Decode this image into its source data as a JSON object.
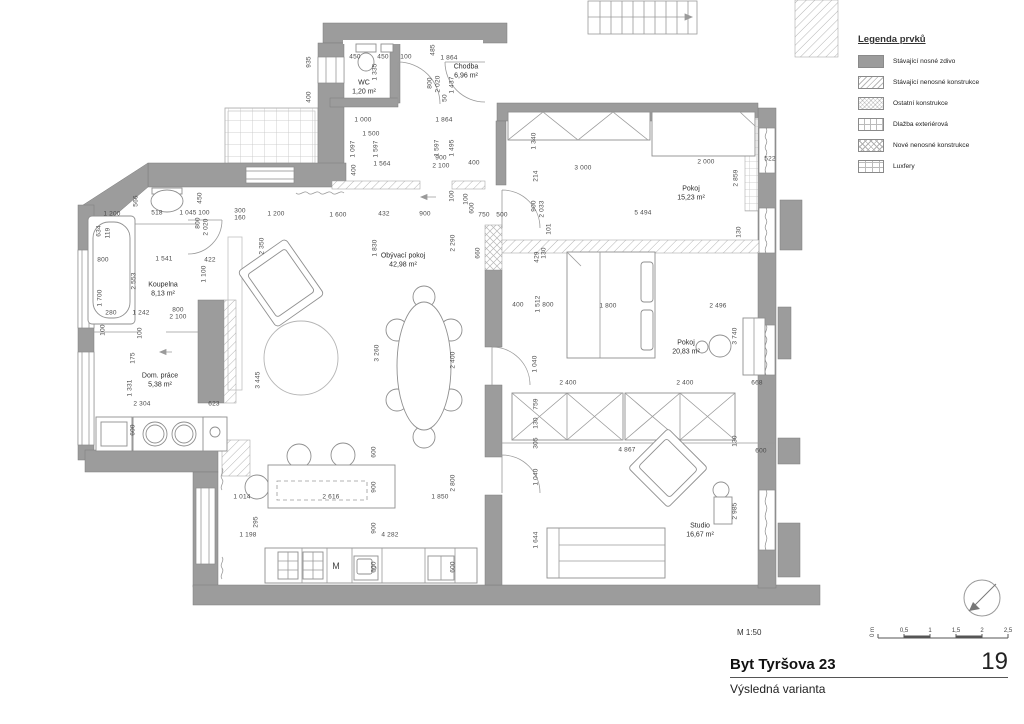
{
  "legend": {
    "title": "Legenda prvků",
    "items": [
      {
        "label": "Stávající nosné zdivo",
        "swatch": "solid"
      },
      {
        "label": "Stávající nenosné konstrukce",
        "swatch": "diag"
      },
      {
        "label": "Ostatní konstrukce",
        "swatch": "diag2"
      },
      {
        "label": "Dlažba exteriérová",
        "swatch": "grid"
      },
      {
        "label": "Nové nenosné konstrukce",
        "swatch": "cross"
      },
      {
        "label": "Luxfery",
        "swatch": "lux"
      }
    ]
  },
  "titleblock": {
    "scale_note": "M 1:50",
    "title": "Byt Tyršova 23",
    "sheet_number": "19",
    "subtitle": "Výsledná varianta",
    "scalebar_zero": "0 m",
    "scalebar_labels": [
      "0,5",
      "1",
      "1,5",
      "2",
      "2,5"
    ]
  },
  "rooms": [
    {
      "name": "WC",
      "area": "1,20 m²",
      "x": 364,
      "y": 88
    },
    {
      "name": "Chodba",
      "area": "6,96 m²",
      "x": 466,
      "y": 72
    },
    {
      "name": "Koupelna",
      "area": "8,13 m²",
      "x": 163,
      "y": 290
    },
    {
      "name": "Dom. práce",
      "area": "5,38 m²",
      "x": 160,
      "y": 381
    },
    {
      "name": "Obývací pokoj",
      "area": "42,98 m²",
      "x": 403,
      "y": 261
    },
    {
      "name": "Pokoj",
      "area": "15,23 m²",
      "x": 691,
      "y": 194
    },
    {
      "name": "Pokoj",
      "area": "20,83 m²",
      "x": 686,
      "y": 348
    },
    {
      "name": "Studio",
      "area": "16,67 m²",
      "x": 700,
      "y": 531
    }
  ],
  "appliance_label": {
    "text": "M",
    "x": 336,
    "y": 566
  },
  "dims": [
    [
      "450",
      355,
      57,
      0
    ],
    [
      "450",
      383,
      57,
      0
    ],
    [
      "100",
      406,
      57,
      0
    ],
    [
      "485",
      433,
      50,
      1
    ],
    [
      "1 864",
      449,
      58,
      0
    ],
    [
      "935",
      309,
      62,
      1
    ],
    [
      "400",
      309,
      97,
      1
    ],
    [
      "1 335",
      375,
      72,
      1
    ],
    [
      "800",
      430,
      83,
      1
    ],
    [
      "2 020",
      438,
      84,
      1
    ],
    [
      "1 437",
      452,
      85,
      1
    ],
    [
      "50",
      445,
      98,
      1
    ],
    [
      "1 000",
      363,
      120,
      0
    ],
    [
      "1 864",
      444,
      120,
      0
    ],
    [
      "1 500",
      371,
      134,
      0
    ],
    [
      "1 097",
      353,
      149,
      1
    ],
    [
      "1 597",
      376,
      149,
      1
    ],
    [
      "1 597",
      437,
      148,
      1
    ],
    [
      "1 495",
      452,
      148,
      1
    ],
    [
      "1 564",
      382,
      164,
      0
    ],
    [
      "900",
      441,
      158,
      0
    ],
    [
      "2 100",
      441,
      166,
      0
    ],
    [
      "400",
      474,
      163,
      0
    ],
    [
      "400",
      354,
      170,
      1
    ],
    [
      "100",
      452,
      196,
      1
    ],
    [
      "100",
      466,
      199,
      1
    ],
    [
      "600",
      472,
      208,
      1
    ],
    [
      "1 200",
      112,
      214,
      0
    ],
    [
      "566",
      136,
      201,
      1
    ],
    [
      "518",
      157,
      213,
      0
    ],
    [
      "450",
      200,
      198,
      1
    ],
    [
      "1 045",
      188,
      213,
      0
    ],
    [
      "100",
      204,
      213,
      0
    ],
    [
      "300",
      240,
      211,
      0
    ],
    [
      "160",
      240,
      218,
      0
    ],
    [
      "1 200",
      276,
      214,
      0
    ],
    [
      "1 600",
      338,
      215,
      0
    ],
    [
      "432",
      384,
      214,
      0
    ],
    [
      "900",
      425,
      214,
      0
    ],
    [
      "750",
      484,
      215,
      0
    ],
    [
      "500",
      502,
      215,
      0
    ],
    [
      "634",
      99,
      231,
      1
    ],
    [
      "119",
      108,
      233,
      1
    ],
    [
      "800",
      198,
      223,
      1
    ],
    [
      "2 020",
      206,
      227,
      1
    ],
    [
      "2 350",
      262,
      246,
      1
    ],
    [
      "800",
      103,
      260,
      0
    ],
    [
      "1 541",
      164,
      259,
      0
    ],
    [
      "422",
      210,
      260,
      0
    ],
    [
      "2 553",
      134,
      281,
      1
    ],
    [
      "1 100",
      204,
      274,
      1
    ],
    [
      "1 700",
      100,
      298,
      1
    ],
    [
      "280",
      111,
      313,
      0
    ],
    [
      "1 242",
      141,
      313,
      0
    ],
    [
      "800",
      178,
      310,
      0
    ],
    [
      "2 100",
      178,
      317,
      0
    ],
    [
      "100",
      103,
      330,
      1
    ],
    [
      "100",
      140,
      333,
      1
    ],
    [
      "175",
      133,
      358,
      1
    ],
    [
      "1 331",
      130,
      388,
      1
    ],
    [
      "2 304",
      142,
      404,
      0
    ],
    [
      "623",
      214,
      404,
      0
    ],
    [
      "600",
      133,
      430,
      1
    ],
    [
      "3 445",
      258,
      380,
      1
    ],
    [
      "1 830",
      375,
      248,
      1
    ],
    [
      "2 290",
      453,
      243,
      1
    ],
    [
      "660",
      478,
      253,
      1
    ],
    [
      "3 260",
      377,
      353,
      1
    ],
    [
      "2 400",
      453,
      360,
      1
    ],
    [
      "400",
      518,
      305,
      0
    ],
    [
      "800",
      548,
      305,
      0
    ],
    [
      "1 340",
      534,
      141,
      1
    ],
    [
      "3 000",
      583,
      168,
      0
    ],
    [
      "2 000",
      706,
      162,
      0
    ],
    [
      "522",
      770,
      159,
      0
    ],
    [
      "2 859",
      736,
      178,
      1
    ],
    [
      "214",
      536,
      176,
      1
    ],
    [
      "900",
      534,
      206,
      1
    ],
    [
      "2 033",
      542,
      209,
      1
    ],
    [
      "5 494",
      643,
      213,
      0
    ],
    [
      "130",
      739,
      232,
      1
    ],
    [
      "101",
      549,
      229,
      1
    ],
    [
      "429",
      537,
      257,
      1
    ],
    [
      "130",
      544,
      253,
      1
    ],
    [
      "1 512",
      538,
      304,
      1
    ],
    [
      "1 800",
      608,
      306,
      0
    ],
    [
      "2 496",
      718,
      306,
      0
    ],
    [
      "3 740",
      735,
      336,
      1
    ],
    [
      "2 400",
      568,
      383,
      0
    ],
    [
      "2 400",
      685,
      383,
      0
    ],
    [
      "668",
      757,
      383,
      0
    ],
    [
      "1 040",
      535,
      364,
      1
    ],
    [
      "759",
      536,
      404,
      1
    ],
    [
      "130",
      536,
      423,
      1
    ],
    [
      "305",
      536,
      443,
      1
    ],
    [
      "4 867",
      627,
      450,
      0
    ],
    [
      "130",
      735,
      441,
      1
    ],
    [
      "600",
      761,
      451,
      0
    ],
    [
      "1 040",
      536,
      477,
      1
    ],
    [
      "2 985",
      735,
      511,
      1
    ],
    [
      "1 644",
      536,
      540,
      1
    ],
    [
      "1 014",
      242,
      497,
      0
    ],
    [
      "2 616",
      331,
      497,
      0
    ],
    [
      "1 850",
      440,
      497,
      0
    ],
    [
      "600",
      374,
      452,
      1
    ],
    [
      "900",
      374,
      487,
      1
    ],
    [
      "2 800",
      453,
      483,
      1
    ],
    [
      "295",
      256,
      522,
      1
    ],
    [
      "1 198",
      248,
      535,
      0
    ],
    [
      "4 282",
      390,
      535,
      0
    ],
    [
      "900",
      374,
      528,
      1
    ],
    [
      "600",
      374,
      567,
      1
    ],
    [
      "600",
      453,
      567,
      1
    ]
  ],
  "colors": {
    "wall": "#9c9c9c",
    "line": "#9a9a9a",
    "dim_text": "#4a4a4a"
  }
}
